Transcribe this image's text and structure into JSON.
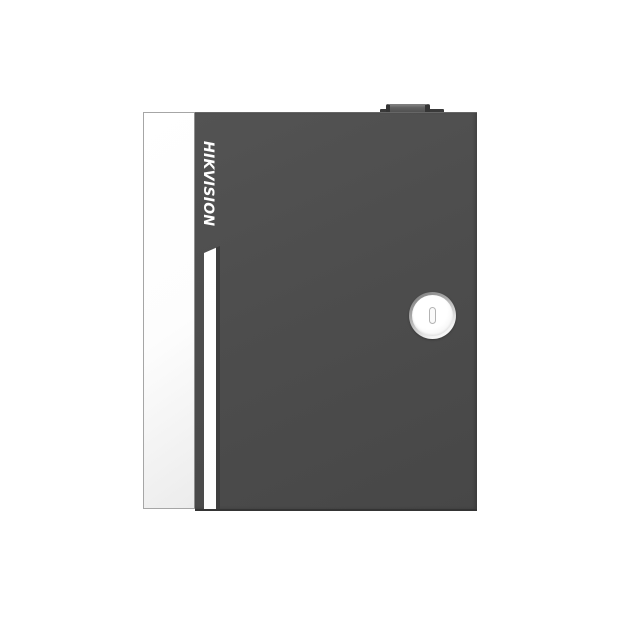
{
  "scene": {
    "type": "product-photo",
    "subject": "Wall-mount security control panel enclosure, front view, centered on white background",
    "background": "#ffffff"
  },
  "device": {
    "brand": "HIKVISION",
    "parts": {
      "door_edge_panel": "white open-door edge panel on left side",
      "door_face": "dark gray metal door",
      "accent_stripe": "vertical white stripe with chamfered top below the logo",
      "lock": "round silver cam lock with vertical keyhole on right side",
      "top_hinge": "small dark latch/hinge bump on top edge"
    }
  },
  "colors": {
    "background": "#ffffff",
    "door-face": "#4d4d4d",
    "door-face-light": "#535353",
    "door-face-darker": "#474747",
    "door-top-highlight": "#666666",
    "door-bottom-edge": "#343434",
    "panel-white": "#fdfdfd",
    "panel-white-shade": "#ececec",
    "panel-border": "#a6a6a6",
    "stripe-white": "#fdfdfd",
    "stripe-recess": "#3d3d3d",
    "brand-text": "#ffffff",
    "hinge-cap": "#606060",
    "hinge-cap-dark": "#4a4a4a",
    "hinge-cap-highlight": "#7d7d7d",
    "hinge-dark": "#3a3a3a",
    "hinge-notch": "#353535",
    "lock-ring-dark": "#757575",
    "lock-ring-mid": "#a8a8a8",
    "lock-ring-light": "#f2f2f2",
    "lock-face": "#ffffff",
    "lock-face-shade": "#e4e4e4",
    "keyhole-stroke": "#b3b3b3",
    "keyhole-fill": "#fafafa"
  }
}
